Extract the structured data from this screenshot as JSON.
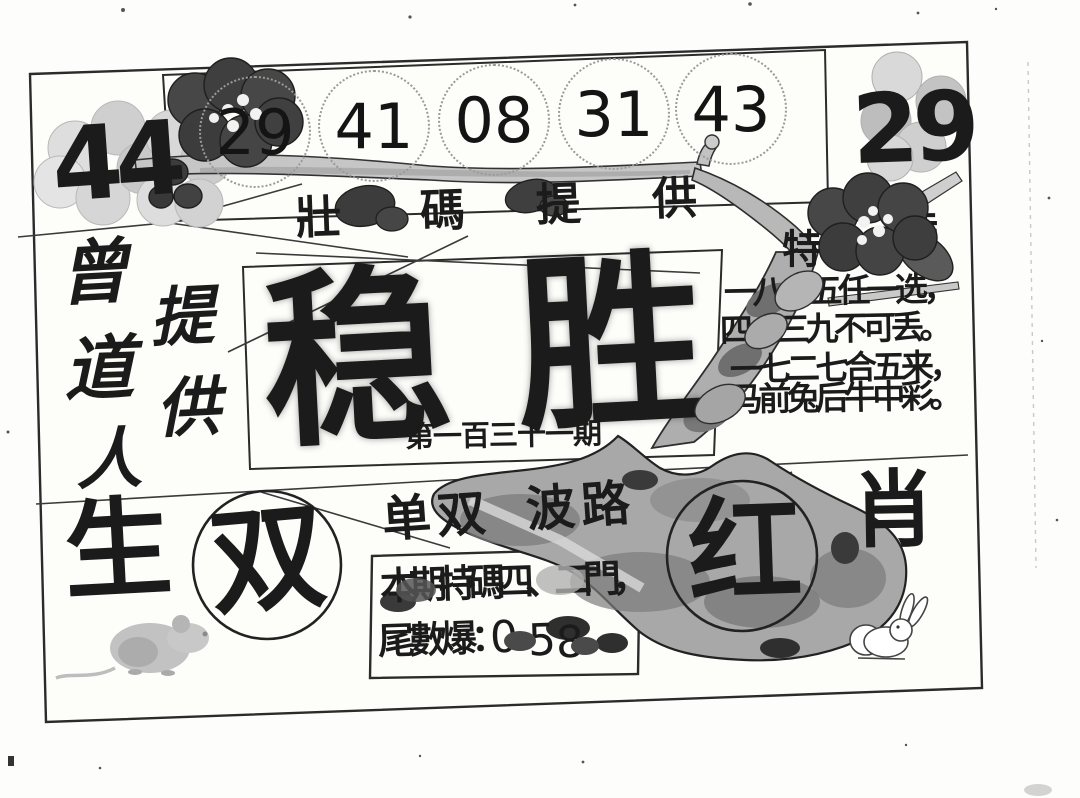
{
  "header": {
    "big_left_number": "44",
    "ball_numbers": [
      "29",
      "41",
      "08",
      "31",
      "43"
    ],
    "big_right_number": "29",
    "banner_chars": [
      "壯",
      "碼",
      "提",
      "供"
    ]
  },
  "left_column": {
    "provider_chars": [
      "曾",
      "道",
      "人"
    ],
    "provide_chars": [
      "提",
      "供"
    ],
    "zodiac_left": "生"
  },
  "title": {
    "char1": "稳",
    "char2": "胜",
    "issue": "第一百三十一期"
  },
  "poem": {
    "label_left": "特",
    "label_right": "特",
    "line1": "一八二五任一选，",
    "line2": "四一三九不可丢。",
    "line3": "一七二七合五来，",
    "line4": "马前兔后牛中彩。"
  },
  "bottom": {
    "parity_label": "单双",
    "wave_label": "波路",
    "circle_parity": "双",
    "circle_color": "红",
    "zodiac_right": "肖",
    "tip_line1": "本期特碼四、二門，",
    "tip_label2": "尾數爆：",
    "tip_digits": [
      "0",
      "5",
      "8"
    ]
  },
  "colors": {
    "paper": "#fdfdfb",
    "ink": "#1b1b1b",
    "branch_fill": "#c6c6c6",
    "trunk_fill": "#a8a8a8",
    "flower_dark": "#474747",
    "flower_light": "#dadada"
  }
}
